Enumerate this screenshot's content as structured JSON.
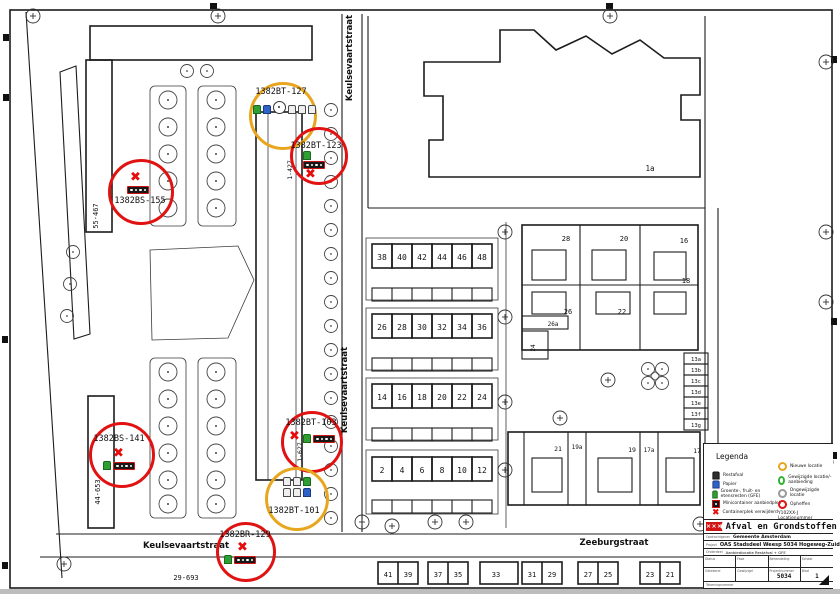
{
  "map": {
    "streets": {
      "keulsevaartstraat_top": "Keulsevaartstraat",
      "keulsevaartstraat_mid": "Keulsevaartstraat",
      "keulsevaartstraat_bottom": "Keulsevaartstraat",
      "zeeburgstraat": "Zeeburgstraat"
    },
    "ranges": {
      "left_top": "55-467",
      "left_bottom": "44-653",
      "center_top": "1-427",
      "center_bottom": "1-627",
      "bottom_left": "29-693",
      "school": "1a"
    },
    "houses": {
      "rows": [
        [
          "38",
          "40",
          "42",
          "44",
          "46",
          "48"
        ],
        [
          "26",
          "28",
          "30",
          "32",
          "34",
          "36"
        ],
        [
          "14",
          "16",
          "18",
          "20",
          "22",
          "24"
        ],
        [
          "2",
          "4",
          "6",
          "8",
          "10",
          "12"
        ]
      ],
      "right_block": [
        "28",
        "20",
        "16",
        "18",
        "26",
        "22",
        "26a",
        "24"
      ],
      "lower_right": [
        "21",
        "19a",
        "19",
        "17a",
        "17"
      ],
      "bottom_row": [
        "41",
        "39",
        "37",
        "35",
        "33",
        "31",
        "29",
        "27",
        "25",
        "23",
        "21"
      ],
      "stack": [
        "13a",
        "13b",
        "13c",
        "13d",
        "13e",
        "13f",
        "13g"
      ]
    },
    "markers": [
      {
        "label": "1382BT-127",
        "status": "nieuw"
      },
      {
        "label": "1382BT-123",
        "status": "opheffen"
      },
      {
        "label": "1382BS-155",
        "status": "opheffen"
      },
      {
        "label": "1382BS-141",
        "status": "opheffen"
      },
      {
        "label": "1382BT-103",
        "status": "opheffen"
      },
      {
        "label": "1382BT-101",
        "status": "nieuw"
      },
      {
        "label": "1382BR-129",
        "status": "opheffen"
      }
    ]
  },
  "legend": {
    "title": "Legenda",
    "waste_types": [
      {
        "icon": "restafval-bin-icon",
        "label": "Restafval",
        "color": "#2f2f2f"
      },
      {
        "icon": "papier-bin-icon",
        "label": "Papier",
        "color": "#2f62c9"
      },
      {
        "icon": "gfe-bin-icon",
        "label": "Groente-, fruit- en etensresten (GFE)",
        "color": "#2f9e33"
      },
      {
        "icon": "minicontainer-icon",
        "label": "Minicontainer aanbiedplek"
      },
      {
        "icon": "removed-x-icon",
        "label": "Containerplek verwijderd"
      }
    ],
    "statuses": [
      {
        "icon": "new-location-circle",
        "label": "Nieuwe locatie",
        "color": "#e8a61e"
      },
      {
        "icon": "changed-location-circle",
        "label": "Gewijzigde locatie/-aanbieding",
        "color": "#2fb52f"
      },
      {
        "icon": "unchanged-location-circle",
        "label": "Ongewijzigde locatie",
        "color": "#9a9a9a"
      },
      {
        "icon": "remove-location-circle",
        "label": "Opheffen",
        "color": "#e01212"
      }
    ],
    "location_number_note": "Y102XX-J Locatienummer"
  },
  "title_block": {
    "department": "Afval en Grondstoffen",
    "client_label": "Opdrachtgever",
    "client": "Gemeente Amsterdam",
    "project_label": "Project",
    "project": "OAS Stadsdeel Weesp 5034 Hogeweg-Zuid",
    "subject_label": "Onderdeel",
    "subject": "Aanbiedlocatie Restafval + GFE",
    "fields": [
      {
        "label": "Status",
        "value": ""
      },
      {
        "label": "Fase",
        "value": ""
      },
      {
        "label": "Behandeling",
        "value": ""
      },
      {
        "label": "Schaal",
        "value": ""
      },
      {
        "label": "Getekend",
        "value": ""
      },
      {
        "label": "Gewijzigd",
        "value": ""
      },
      {
        "label": "Projectnummer",
        "value": "5034"
      },
      {
        "label": "Blad",
        "value": "1"
      }
    ],
    "drawing_number_label": "Tekeningnummer"
  },
  "icons": {
    "removed_glyph": "✖",
    "logo_glyph": "×××"
  },
  "colors": {
    "new_location": "#e8a61e",
    "changed_location": "#2fb52f",
    "unchanged_location": "#9a9a9a",
    "remove_location": "#e01212",
    "restafval": "#2f2f2f",
    "papier": "#2f62c9",
    "gfe": "#2f9e33",
    "container_bar_border": "#cf1212"
  }
}
